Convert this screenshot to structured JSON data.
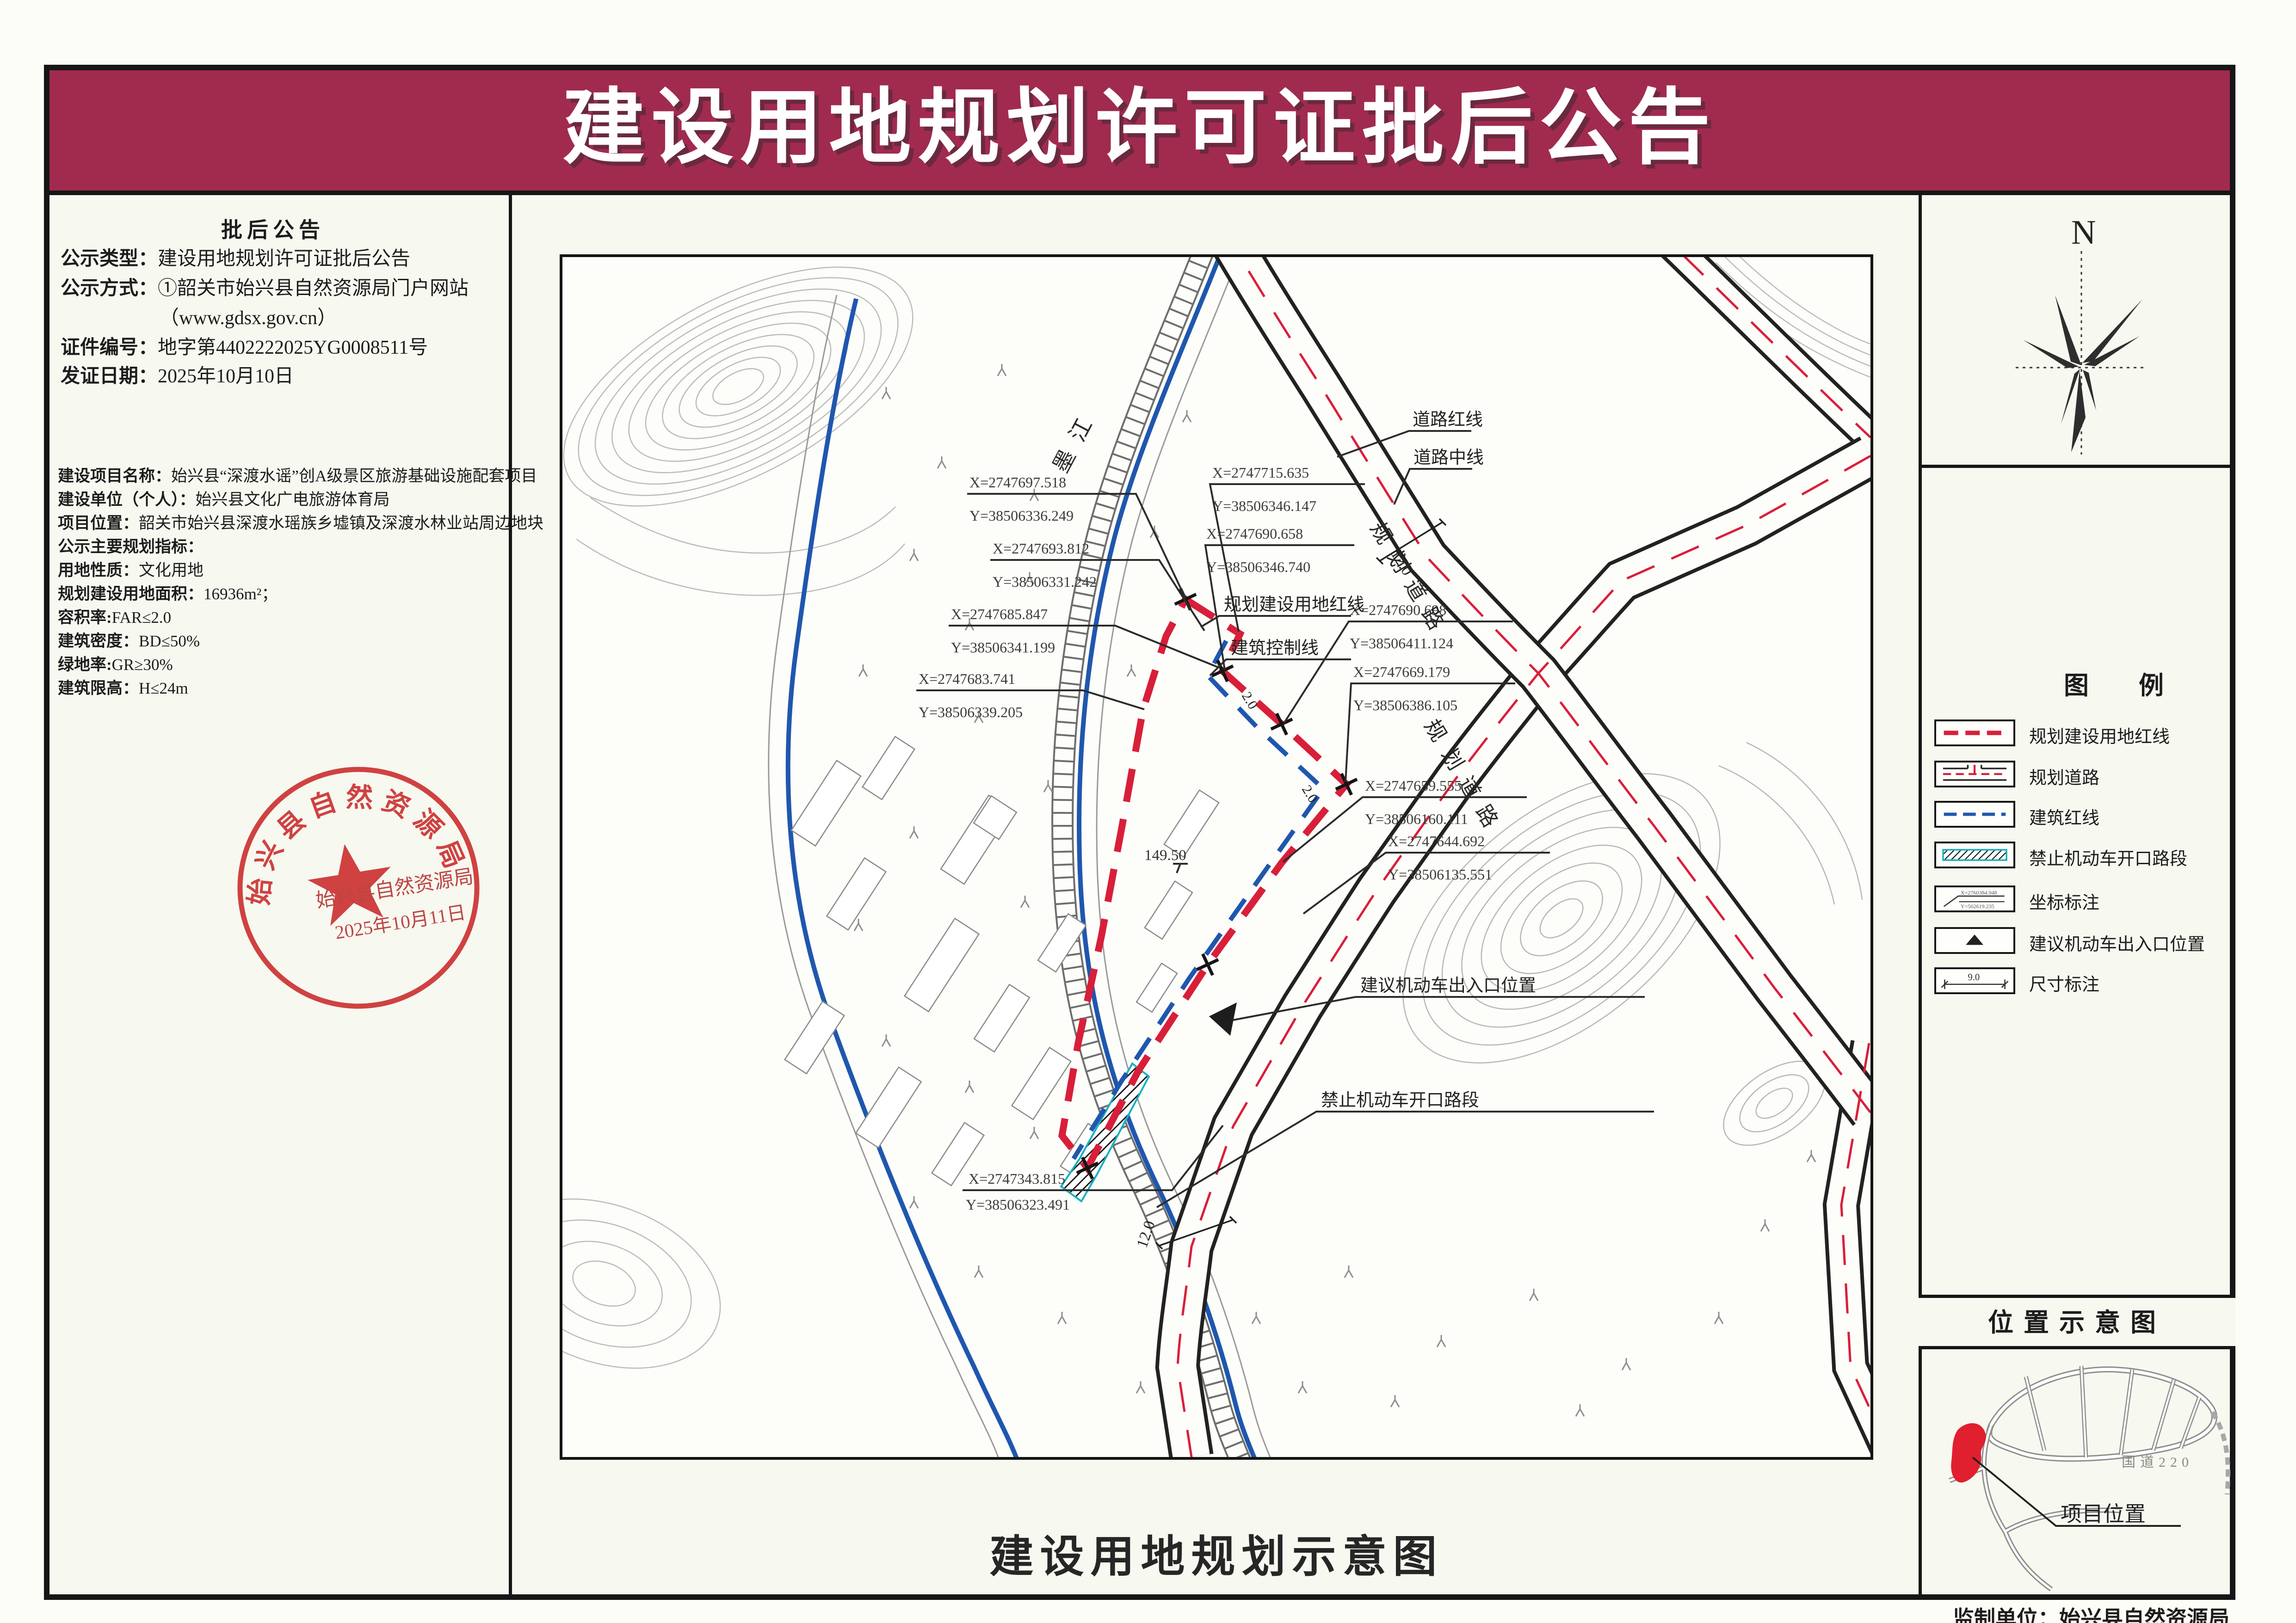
{
  "banner": {
    "title": "建设用地规划许可证批后公告"
  },
  "colors": {
    "banner_bg": "#a02b4e",
    "red_line": "#d81f3a",
    "blue_line": "#1f57ae",
    "seal_red": "#cc3333"
  },
  "left_panel": {
    "heading": "批后公告",
    "rows": [
      {
        "label": "公示类型：",
        "value": "建设用地规划许可证批后公告"
      },
      {
        "label": "公示方式：",
        "value": "①韶关市始兴县自然资源局门户网站"
      },
      {
        "label": "",
        "value": "（www.gdsx.gov.cn）"
      },
      {
        "label": "证件编号：",
        "value": "地字第4402222025YG0008511号"
      },
      {
        "label": "发证日期：",
        "value": "2025年10月10日"
      }
    ],
    "project_rows": [
      {
        "label": "建设项目名称：",
        "value": "始兴县“深渡水谣”创A级景区旅游基础设施配套项目"
      },
      {
        "label": "建设单位（个人）：",
        "value": "始兴县文化广电旅游体育局"
      },
      {
        "label": "项目位置：",
        "value": "韶关市始兴县深渡水瑶族乡墟镇及深渡水林业站周边地块"
      },
      {
        "label": "公示主要规划指标：",
        "value": ""
      },
      {
        "label": "用地性质：",
        "value": "文化用地"
      },
      {
        "label": "规划建设用地面积：",
        "value": "16936m²；"
      },
      {
        "label": "容积率:",
        "value": "FAR≤2.0"
      },
      {
        "label": "建筑密度：",
        "value": "BD≤50%"
      },
      {
        "label": "绿地率:",
        "value": "GR≥30%"
      },
      {
        "label": "建筑限高：",
        "value": "H≤24m"
      }
    ]
  },
  "seal": {
    "ring_text": "始兴县自然资源局",
    "name": "始兴县自然资源局",
    "date": "2025年10月11日"
  },
  "map": {
    "caption": "建设用地规划示意图",
    "labels": {
      "river": "墨江",
      "road_redline": "道路红线",
      "road_centerline": "道路中线",
      "site_redline": "规划建设用地红线",
      "building_control": "建筑控制线",
      "planned_road": "规划道路",
      "entrance": "建议机动车出入口位置",
      "no_opening": "禁止机动车开口路段",
      "elevation": "149.50",
      "dim_road": "12.0",
      "dim_setback": "2.0"
    },
    "coords": [
      {
        "x": "X=2747697.518",
        "y": "Y=38506336.249"
      },
      {
        "x": "X=2747693.812",
        "y": "Y=38506331.242"
      },
      {
        "x": "X=2747685.847",
        "y": "Y=38506341.199"
      },
      {
        "x": "X=2747683.741",
        "y": "Y=38506339.205"
      },
      {
        "x": "X=2747715.635",
        "y": "Y=38506346.147"
      },
      {
        "x": "X=2747690.658",
        "y": "Y=38506346.740"
      },
      {
        "x": "X=2747690.698",
        "y": "Y=38506411.124"
      },
      {
        "x": "X=2747669.179",
        "y": "Y=38506386.105"
      },
      {
        "x": "X=2747659.555",
        "y": "Y=38506160.111"
      },
      {
        "x": "X=2747644.692",
        "y": "Y=38506135.551"
      },
      {
        "x": "X=2747343.815",
        "y": "Y=38506323.491"
      }
    ]
  },
  "north": {
    "label": "N"
  },
  "legend": {
    "title": "图　　例",
    "items": [
      {
        "label": "规划建设用地红线"
      },
      {
        "label": "规划道路"
      },
      {
        "label": "建筑红线"
      },
      {
        "label": "禁止机动车开口路段"
      },
      {
        "label": "坐标标注",
        "sym_x": "X=2760384.948",
        "sym_y": "Y=502619.235"
      },
      {
        "label": "建议机动车出入口位置"
      },
      {
        "label": "尺寸标注",
        "sym_dim": "9.0"
      }
    ]
  },
  "location": {
    "title": "位置示意图",
    "road_label": "国道220",
    "marker_label": "项目位置"
  },
  "footer": {
    "producer": "监制单位：始兴县自然资源局"
  }
}
